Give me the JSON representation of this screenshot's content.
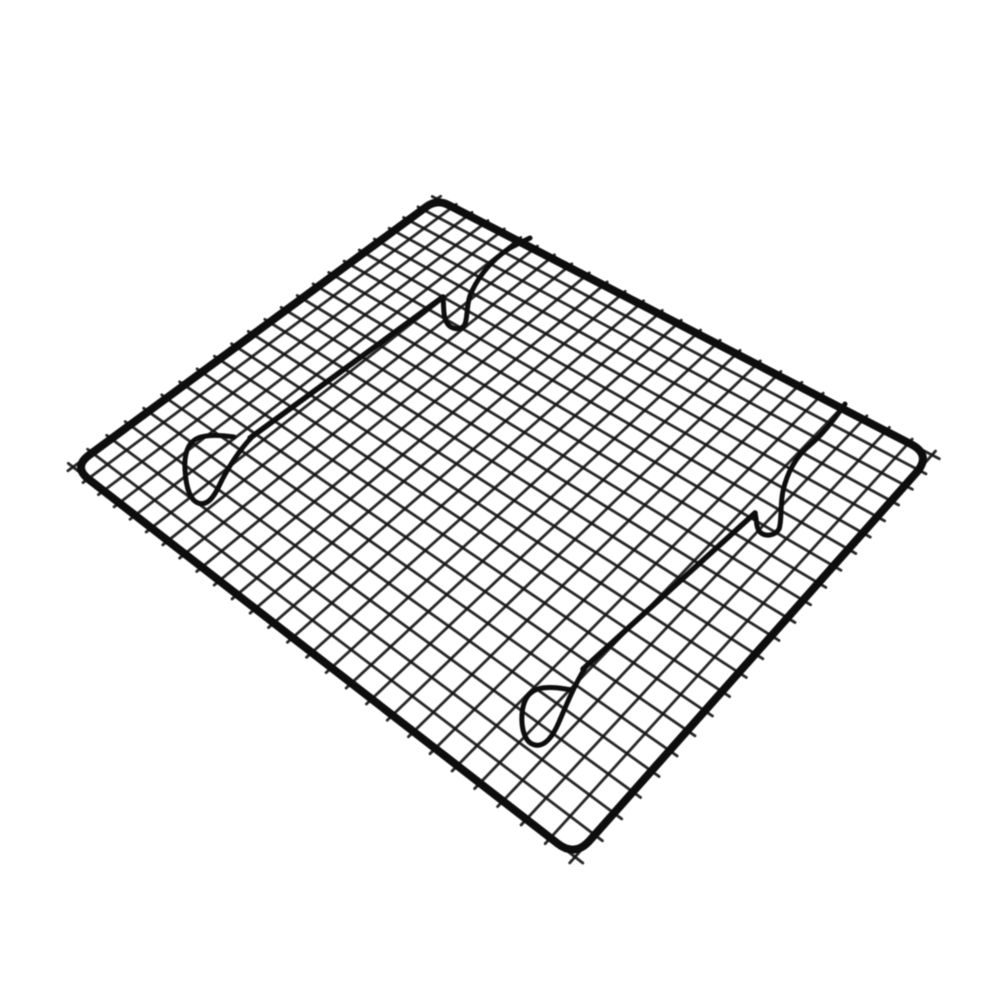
{
  "image": {
    "alt": "Black non-stick steel wire cooling rack for baking, photographed at an angle on a plain white background",
    "background_color": "#ffffff"
  },
  "rack": {
    "wire_color": "#161616",
    "frame_color": "#0a0a0a",
    "bar_color": "#0d0d0d",
    "mesh_opacity": 0.93,
    "frame_stroke_width": 8,
    "mesh_stroke_width": 2.8,
    "bar_stroke_width": 5.5,
    "foot_stroke_width": 5,
    "corners": {
      "left": [
        73,
        467
      ],
      "top": [
        437,
        199
      ],
      "right": [
        932,
        455
      ],
      "bottom": [
        575,
        857
      ]
    },
    "corner_radii": {
      "left": 20,
      "top": 13,
      "right": 24,
      "bottom": 22
    },
    "grid": {
      "cells_u": 22,
      "cells_v": 26,
      "overshoot": 0.012
    },
    "support_bars": [
      {
        "name": "far-support-bar",
        "run_path": "M 443 297 L 250 438",
        "feet": [
          "M 252 437 C 240 449 227 469 219 486 C 213 499 206 506 198 503 C 190 500 186 487 185 470 C 184 456 187 444 196 439 C 205 434 220 435 234 437",
          "M 443 297 C 444 307 443 317 447 323 C 451 330 462 331 465 324 C 468 316 466 303 472 291 C 480 274 494 258 510 248 C 517 244 524 241 530 238"
        ]
      },
      {
        "name": "near-support-bar",
        "run_path": "M 755 513 L 583 669",
        "feet": [
          "M 585 668 C 574 686 566 706 559 722 C 553 736 545 747 535 745 C 525 743 521 729 522 714 C 523 701 528 692 538 689 C 548 686 560 688 572 690",
          "M 755 513 C 757 521 756 528 760 532 C 765 537 775 536 779 529 C 782 521 780 505 783 491 C 787 473 796 456 810 445 C 822 435 834 420 845 404"
        ]
      }
    ]
  }
}
